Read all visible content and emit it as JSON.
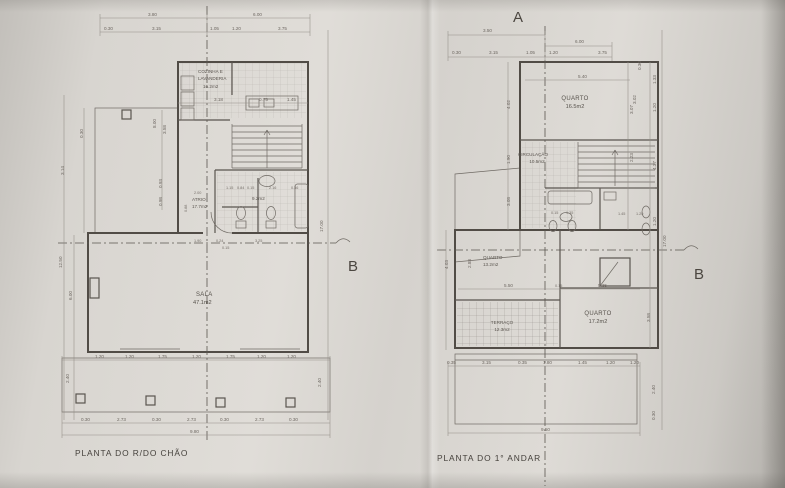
{
  "colors": {
    "paper": "#dcd9d4",
    "line": "#6b665f",
    "wall": "#514c46",
    "text": "#5f5a54"
  },
  "left_plan": {
    "title": "PLANTA DO R/DO CHÃO",
    "section_marker": "B",
    "rooms": {
      "kitchen": {
        "line1": "COZINHA E",
        "line2": "LAVANDERIA",
        "area": "16.2m2"
      },
      "atrio": {
        "name": "ATRIO",
        "area": "17.7m2"
      },
      "bathroom": {
        "area": "9.2m2"
      },
      "sala": {
        "name": "SALA",
        "area": "47.1m2"
      }
    },
    "dims": {
      "top1": [
        "3.80",
        "6.00"
      ],
      "top2": [
        "0.30",
        "3.15",
        "1.05",
        "1.20",
        "3.75"
      ],
      "left_outer": [
        "12.50",
        "6.00"
      ],
      "left_inner": [
        "0.30",
        "3.14",
        "8.00",
        "3.58",
        "0.93",
        "0.98"
      ],
      "right": [
        "17.00"
      ],
      "kitchen_row": [
        "3.18",
        "0.75",
        "1.45"
      ],
      "bath_row": [
        "1.15",
        "0.84",
        "0.15",
        "2.16",
        "0.36"
      ],
      "atrio_col": [
        "2.00",
        "0.88"
      ],
      "middle_row": [
        "1.90",
        "0.24",
        "3.25",
        "0.15"
      ],
      "bottom1": [
        "1.20",
        "1.20",
        "1.75",
        "1.20",
        "1.75",
        "1.20",
        "1.20"
      ],
      "bottom_sides": [
        "2.40",
        "2.40"
      ],
      "bottom2": [
        "0.30",
        "2.73",
        "0.30",
        "2.73",
        "0.30",
        "2.73",
        "0.30"
      ],
      "total": "9.80"
    }
  },
  "right_plan": {
    "title": "PLANTA DO 1° ANDAR",
    "marker_a": "A",
    "section_marker": "B",
    "rooms": {
      "quarto1": {
        "name": "QUARTO",
        "area": "16.5m2"
      },
      "circulacao": {
        "name": "CIRCULAÇÃO",
        "area": "10.5m2"
      },
      "quarto2": {
        "name": "QUARTO",
        "area": "13.2m2"
      },
      "quarto3": {
        "name": "QUARTO",
        "area": "17.2m2"
      },
      "terraco": {
        "name": "TERRAÇO",
        "area": "12.3m2"
      }
    },
    "dims": {
      "top1": [
        "3.50",
        "6.00"
      ],
      "top2": [
        "0.30",
        "3.15",
        "1.05",
        "1.20",
        "3.75"
      ],
      "quarto1": [
        "5.40",
        "3.02"
      ],
      "right_outer": [
        "17.00"
      ],
      "right_inner": [
        "0.30",
        "1.33",
        "1.20",
        "3.07",
        "2.23",
        "4.37",
        "1.20"
      ],
      "left_col": [
        "4.02",
        "1.90",
        "3.08",
        "4.03",
        "2.88"
      ],
      "middle": [
        "5.50",
        "0.15",
        "5.35",
        "3.58"
      ],
      "bath_row": [
        "0.15",
        "1.35",
        "1.45",
        "1.20"
      ],
      "bottom1": [
        "0.35",
        "3.15",
        "0.35",
        "1.80",
        "1.45",
        "1.20",
        "1.20"
      ],
      "bottom_sides": [
        "2.40",
        "0.30"
      ],
      "total": "9.50"
    }
  }
}
